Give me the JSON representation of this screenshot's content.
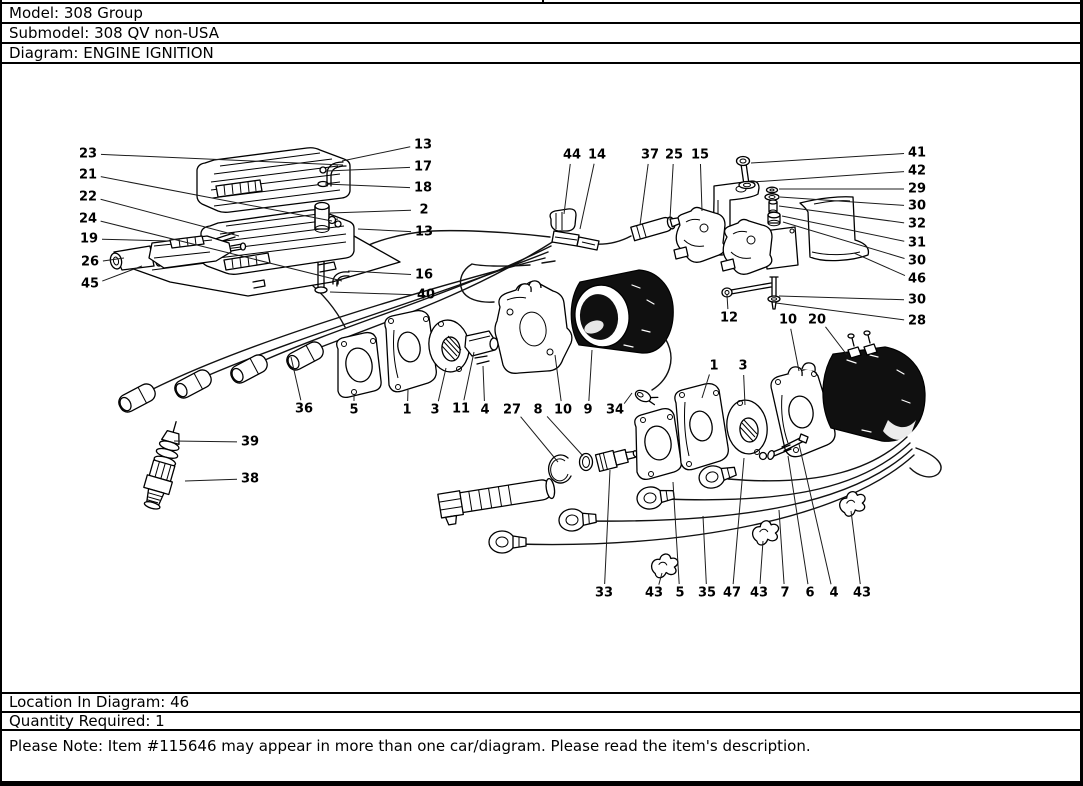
{
  "page": {
    "colors": {
      "ink": "#000000",
      "paper": "#ffffff",
      "shade": "#101010"
    }
  },
  "header": {
    "rows": [
      {
        "id": "model",
        "text": "Model: 308 Group"
      },
      {
        "id": "submodel",
        "text": "Submodel: 308 QV non-USA"
      },
      {
        "id": "diagram",
        "text": "Diagram: ENGINE IGNITION"
      }
    ]
  },
  "footer": {
    "rows": [
      {
        "id": "location",
        "text": "Location In Diagram: 46"
      },
      {
        "id": "quantity",
        "text": "Quantity Required: 1"
      },
      {
        "id": "note",
        "text": "Please Note: Item #115646 may appear in more than one car/diagram. Please read the item's description."
      }
    ]
  },
  "diagram": {
    "title": "ENGINE IGNITION",
    "callouts": [
      {
        "n": "23",
        "x": 86,
        "y": 154,
        "tx": 341,
        "ty": 165
      },
      {
        "n": "21",
        "x": 86,
        "y": 175,
        "tx": 330,
        "ty": 221
      },
      {
        "n": "22",
        "x": 86,
        "y": 197,
        "tx": 237,
        "ty": 236
      },
      {
        "n": "24",
        "x": 86,
        "y": 219,
        "tx": 340,
        "ty": 281
      },
      {
        "n": "19",
        "x": 87,
        "y": 239,
        "tx": 167,
        "ty": 241
      },
      {
        "n": "26",
        "x": 88,
        "y": 262,
        "tx": 122,
        "ty": 258
      },
      {
        "n": "45",
        "x": 88,
        "y": 284,
        "tx": 140,
        "ty": 266
      },
      {
        "n": "13",
        "x": 421,
        "y": 145,
        "tx": 340,
        "ty": 161
      },
      {
        "n": "17",
        "x": 421,
        "y": 167,
        "tx": 325,
        "ty": 171
      },
      {
        "n": "18",
        "x": 421,
        "y": 188,
        "tx": 323,
        "ty": 184
      },
      {
        "n": "2",
        "x": 422,
        "y": 210,
        "tx": 328,
        "ty": 213
      },
      {
        "n": "13",
        "x": 422,
        "y": 232,
        "tx": 356,
        "ty": 229
      },
      {
        "n": "16",
        "x": 422,
        "y": 275,
        "tx": 346,
        "ty": 271
      },
      {
        "n": "40",
        "x": 424,
        "y": 295,
        "tx": 328,
        "ty": 292
      },
      {
        "n": "44",
        "x": 570,
        "y": 155,
        "tx": 562,
        "ty": 214
      },
      {
        "n": "14",
        "x": 595,
        "y": 155,
        "tx": 578,
        "ty": 229
      },
      {
        "n": "37",
        "x": 648,
        "y": 155,
        "tx": 638,
        "ty": 225
      },
      {
        "n": "25",
        "x": 672,
        "y": 155,
        "tx": 668,
        "ty": 219
      },
      {
        "n": "15",
        "x": 698,
        "y": 155,
        "tx": 700,
        "ty": 211
      },
      {
        "n": "41",
        "x": 915,
        "y": 153,
        "tx": 749,
        "ty": 163
      },
      {
        "n": "42",
        "x": 915,
        "y": 171,
        "tx": 750,
        "ty": 182
      },
      {
        "n": "29",
        "x": 915,
        "y": 189,
        "tx": 777,
        "ty": 189
      },
      {
        "n": "30",
        "x": 915,
        "y": 206,
        "tx": 778,
        "ty": 197
      },
      {
        "n": "32",
        "x": 915,
        "y": 224,
        "tx": 777,
        "ty": 206
      },
      {
        "n": "31",
        "x": 915,
        "y": 243,
        "tx": 780,
        "ty": 216
      },
      {
        "n": "30",
        "x": 915,
        "y": 261,
        "tx": 781,
        "ty": 222
      },
      {
        "n": "46",
        "x": 915,
        "y": 279,
        "tx": 852,
        "ty": 253
      },
      {
        "n": "30",
        "x": 915,
        "y": 300,
        "tx": 777,
        "ty": 296
      },
      {
        "n": "28",
        "x": 915,
        "y": 321,
        "tx": 774,
        "ty": 303
      },
      {
        "n": "12",
        "x": 727,
        "y": 318,
        "tx": 725,
        "ty": 295
      },
      {
        "n": "10",
        "x": 786,
        "y": 320,
        "tx": 797,
        "ty": 371
      },
      {
        "n": "20",
        "x": 815,
        "y": 320,
        "tx": 845,
        "ty": 355
      },
      {
        "n": "1",
        "x": 712,
        "y": 366,
        "tx": 700,
        "ty": 398
      },
      {
        "n": "3",
        "x": 741,
        "y": 366,
        "tx": 743,
        "ty": 405
      },
      {
        "n": "36",
        "x": 302,
        "y": 409,
        "tx": 289,
        "ty": 357
      },
      {
        "n": "5",
        "x": 352,
        "y": 410,
        "tx": 352,
        "ty": 396
      },
      {
        "n": "1",
        "x": 405,
        "y": 410,
        "tx": 406,
        "ty": 390
      },
      {
        "n": "3",
        "x": 433,
        "y": 410,
        "tx": 444,
        "ty": 368
      },
      {
        "n": "11",
        "x": 459,
        "y": 409,
        "tx": 472,
        "ty": 352
      },
      {
        "n": "4",
        "x": 483,
        "y": 410,
        "tx": 481,
        "ty": 366
      },
      {
        "n": "27",
        "x": 510,
        "y": 410,
        "tx": 556,
        "ty": 462
      },
      {
        "n": "8",
        "x": 536,
        "y": 410,
        "tx": 581,
        "ty": 456
      },
      {
        "n": "10",
        "x": 561,
        "y": 410,
        "tx": 553,
        "ty": 355
      },
      {
        "n": "9",
        "x": 586,
        "y": 410,
        "tx": 590,
        "ty": 350
      },
      {
        "n": "34",
        "x": 613,
        "y": 410,
        "tx": 630,
        "ty": 393
      },
      {
        "n": "39",
        "x": 248,
        "y": 442,
        "tx": 172,
        "ty": 441
      },
      {
        "n": "38",
        "x": 248,
        "y": 479,
        "tx": 183,
        "ty": 481
      },
      {
        "n": "33",
        "x": 602,
        "y": 593,
        "tx": 608,
        "ty": 470
      },
      {
        "n": "43",
        "x": 652,
        "y": 593,
        "tx": 660,
        "ty": 573
      },
      {
        "n": "5",
        "x": 678,
        "y": 593,
        "tx": 671,
        "ty": 482
      },
      {
        "n": "35",
        "x": 705,
        "y": 593,
        "tx": 701,
        "ty": 516
      },
      {
        "n": "47",
        "x": 730,
        "y": 593,
        "tx": 742,
        "ty": 458
      },
      {
        "n": "43",
        "x": 757,
        "y": 593,
        "tx": 761,
        "ty": 541
      },
      {
        "n": "7",
        "x": 783,
        "y": 593,
        "tx": 777,
        "ty": 510
      },
      {
        "n": "6",
        "x": 808,
        "y": 593,
        "tx": 786,
        "ty": 456
      },
      {
        "n": "4",
        "x": 832,
        "y": 593,
        "tx": 797,
        "ty": 444
      },
      {
        "n": "43",
        "x": 860,
        "y": 593,
        "tx": 849,
        "ty": 511
      }
    ]
  }
}
